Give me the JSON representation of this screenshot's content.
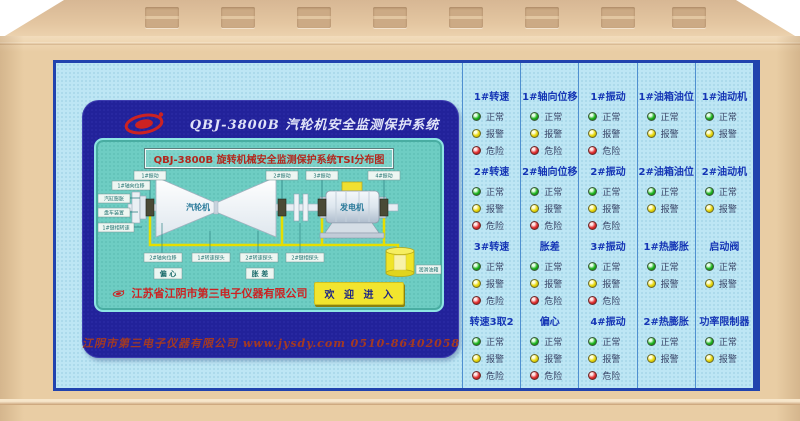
{
  "device": {
    "header_title": "QBJ-3800B  汽轮机安全监测保护系统",
    "footer_line": "江阴市第三电子仪器有限公司  www.jysdy.com   0510-86402058"
  },
  "screen": {
    "diagram_title": "QBJ-3800B 旋转机械安全监测保护系统TSI分布图",
    "company_name": "江苏省江阴市第三电子仪器有限公司",
    "welcome_button": "欢 迎 进 入",
    "diagram": {
      "turbine": "汽轮机",
      "generator": "发电机",
      "tank": "润滑油箱",
      "vib_labels": [
        "1#振动",
        "2#振动",
        "3#振动",
        "4#振动"
      ],
      "left_labels": [
        "1#轴向位移",
        "汽缸膨胀",
        "盘车装置",
        "1#键相转速"
      ],
      "bottom_labels": [
        "2#轴向位移",
        "1#转速探头",
        "2#转速探头",
        "2#键相探头"
      ],
      "eccentricity": "偏 心",
      "diff_expansion": "胀 差"
    }
  },
  "status_panel": {
    "led_defs": {
      "normal": {
        "label": "正常",
        "class": "green"
      },
      "alarm": {
        "label": "报警",
        "class": "yellow"
      },
      "danger": {
        "label": "危险",
        "class": "red"
      }
    },
    "columns": [
      [
        {
          "title": "1#转速",
          "leds": [
            "normal",
            "alarm",
            "danger"
          ]
        },
        {
          "title": "2#转速",
          "leds": [
            "normal",
            "alarm",
            "danger"
          ]
        },
        {
          "title": "3#转速",
          "leds": [
            "normal",
            "alarm",
            "danger"
          ]
        },
        {
          "title": "转速3取2",
          "leds": [
            "normal",
            "alarm",
            "danger"
          ]
        }
      ],
      [
        {
          "title": "1#轴向位移",
          "leds": [
            "normal",
            "alarm",
            "danger"
          ]
        },
        {
          "title": "2#轴向位移",
          "leds": [
            "normal",
            "alarm",
            "danger"
          ]
        },
        {
          "title": "胀差",
          "leds": [
            "normal",
            "alarm",
            "danger"
          ]
        },
        {
          "title": "偏心",
          "leds": [
            "normal",
            "alarm",
            "danger"
          ]
        }
      ],
      [
        {
          "title": "1#振动",
          "leds": [
            "normal",
            "alarm",
            "danger"
          ]
        },
        {
          "title": "2#振动",
          "leds": [
            "normal",
            "alarm",
            "danger"
          ]
        },
        {
          "title": "3#振动",
          "leds": [
            "normal",
            "alarm",
            "danger"
          ]
        },
        {
          "title": "4#振动",
          "leds": [
            "normal",
            "alarm",
            "danger"
          ]
        }
      ],
      [
        {
          "title": "1#油箱油位",
          "leds": [
            "normal",
            "alarm"
          ]
        },
        {
          "title": "2#油箱油位",
          "leds": [
            "normal",
            "alarm"
          ]
        },
        {
          "title": "1#热膨胀",
          "leds": [
            "normal",
            "alarm"
          ]
        },
        {
          "title": "2#热膨胀",
          "leds": [
            "normal",
            "alarm"
          ]
        }
      ],
      [
        {
          "title": "1#油动机",
          "leds": [
            "normal",
            "alarm"
          ]
        },
        {
          "title": "2#油动机",
          "leds": [
            "normal",
            "alarm"
          ]
        },
        {
          "title": "启动阀",
          "leds": [
            "normal",
            "alarm"
          ]
        },
        {
          "title": "功率限制器",
          "leds": [
            "normal",
            "alarm"
          ]
        }
      ]
    ]
  },
  "colors": {
    "case_beige": "#e9cda4",
    "panel_blue": "#bde6f4",
    "panel_border": "#2143ae",
    "bezel_navy": "#22229a",
    "screen_teal": "#6ecdc3",
    "accent_red": "#cc2222",
    "button_yellow": "#f2e52e",
    "led_green": "#1db31d",
    "led_yellow": "#e8d80a",
    "led_red": "#e03030",
    "group_title_blue": "#1535b5"
  }
}
